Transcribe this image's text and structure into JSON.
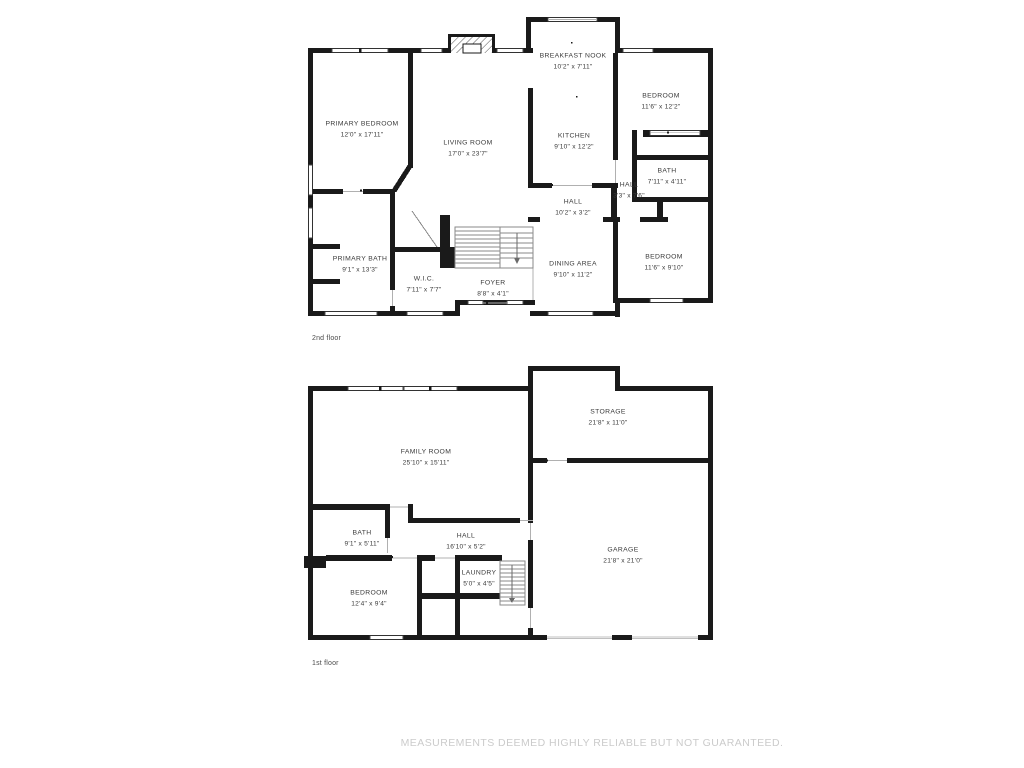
{
  "floors": [
    {
      "label": "2nd floor",
      "rooms": [
        {
          "name": "PRIMARY BEDROOM",
          "dims": "12'0\" x 17'11\""
        },
        {
          "name": "LIVING ROOM",
          "dims": "17'0\" x 23'7\""
        },
        {
          "name": "BREAKFAST NOOK",
          "dims": "10'2\" x 7'11\""
        },
        {
          "name": "KITCHEN",
          "dims": "9'10\" x 12'2\""
        },
        {
          "name": "BEDROOM",
          "dims": "11'6\" x 12'2\""
        },
        {
          "name": "BATH",
          "dims": "7'11\" x 4'11\""
        },
        {
          "name": "HALL",
          "dims": "3'3\" x 7'6\""
        },
        {
          "name": "HALL",
          "dims": "10'2\" x 3'2\""
        },
        {
          "name": "DINING AREA",
          "dims": "9'10\" x 11'2\""
        },
        {
          "name": "BEDROOM",
          "dims": "11'6\" x 9'10\""
        },
        {
          "name": "PRIMARY BATH",
          "dims": "9'1\" x 13'3\""
        },
        {
          "name": "W.I.C.",
          "dims": "7'11\" x 7'7\""
        },
        {
          "name": "FOYER",
          "dims": "8'8\" x 4'1\""
        }
      ]
    },
    {
      "label": "1st floor",
      "rooms": [
        {
          "name": "FAMILY ROOM",
          "dims": "25'10\" x 15'11\""
        },
        {
          "name": "STORAGE",
          "dims": "21'8\" x 11'0\""
        },
        {
          "name": "GARAGE",
          "dims": "21'8\" x 21'0\""
        },
        {
          "name": "BATH",
          "dims": "9'1\" x 5'11\""
        },
        {
          "name": "HALL",
          "dims": "16'10\" x 5'2\""
        },
        {
          "name": "LAUNDRY",
          "dims": "5'0\" x 4'5\""
        },
        {
          "name": "BEDROOM",
          "dims": "12'4\" x 9'4\""
        }
      ]
    }
  ],
  "disclaimer": "MEASUREMENTS DEEMED HIGHLY RELIABLE BUT NOT GUARANTEED.",
  "colors": {
    "wall": "#1a1a1a",
    "label_text": "#3a3a3a",
    "caption_text": "#4b4b4b",
    "disclaimer_text": "#cbcbcb",
    "background": "#ffffff"
  }
}
